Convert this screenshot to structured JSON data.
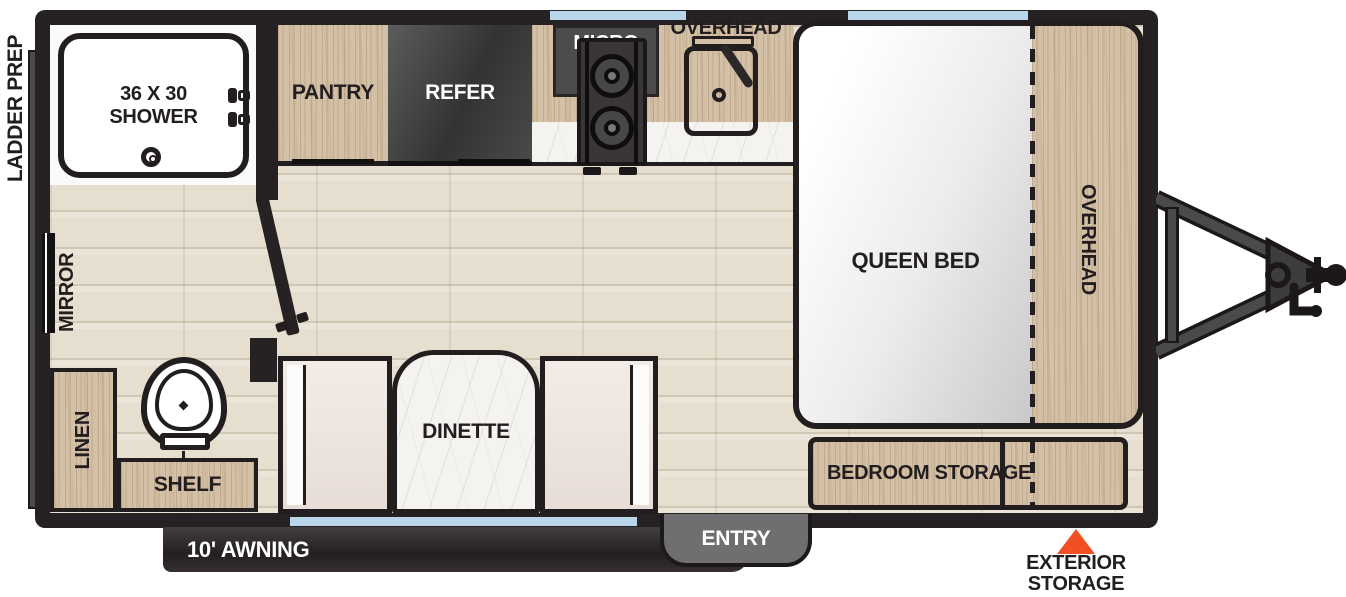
{
  "plan": {
    "exterior": {
      "ladder_prep": "LADDER PREP",
      "awning": "10' AWNING",
      "entry": "ENTRY",
      "exterior_storage_line1": "EXTERIOR",
      "exterior_storage_line2": "STORAGE"
    },
    "bathroom": {
      "shower_line1": "36 X 30",
      "shower_line2": "SHOWER",
      "mirror": "MIRROR",
      "linen": "LINEN",
      "shelf": "SHELF"
    },
    "kitchen": {
      "pantry": "PANTRY",
      "refer": "REFER",
      "micro": "MICRO",
      "overhead": "OVERHEAD"
    },
    "bedroom": {
      "queen_bed": "QUEEN BED",
      "overhead": "OVERHEAD",
      "storage": "BEDROOM STORAGE"
    },
    "dinette": {
      "label": "DINETTE"
    }
  },
  "icons": {
    "exterior_storage_marker": "triangle-up",
    "hitch": "a-frame-tongue-hitch",
    "toilet": "top-view-toilet",
    "shower_drain": "concentric-circles",
    "sink_faucet": "diagonal-faucet"
  },
  "colors": {
    "wall": "#262122",
    "wood": "#d4c0a6",
    "floor": "#e6dfd0",
    "window_blue": "#b9d6ea",
    "marker_orange": "#f05023",
    "appliance_dark": "#4c4b4d",
    "awning_dark": "#2b2627",
    "entry_gray": "#6f6e71"
  }
}
